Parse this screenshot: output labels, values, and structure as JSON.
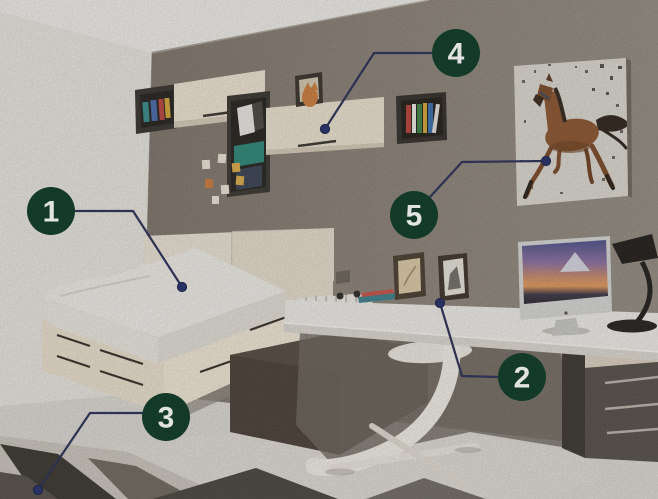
{
  "callouts": {
    "badge_fill": "#0d3a26",
    "badge_text_color": "#ffffff",
    "line_color": "#2b3057",
    "dot_fill": "#263069",
    "items": [
      {
        "number": "1",
        "points_to": "bed"
      },
      {
        "number": "2",
        "points_to": "desk"
      },
      {
        "number": "3",
        "points_to": "rug"
      },
      {
        "number": "4",
        "points_to": "wall-cabinet"
      },
      {
        "number": "5",
        "points_to": "horse-poster"
      }
    ]
  },
  "scene": {
    "kind": "bedroom-photo",
    "palette": {
      "back_wall": "#8a8177",
      "left_wall": "#e4e1da",
      "ceiling": "#ebe9e5",
      "floor": "#d8d5cf",
      "furniture_light": "#e7decb",
      "furniture_dark": "#4a4138",
      "shelf_teal": "#2e8577",
      "horse_brown": "#8a5530",
      "monitor_sky": "#5a5f94",
      "monitor_horizon": "#e0985c"
    }
  }
}
